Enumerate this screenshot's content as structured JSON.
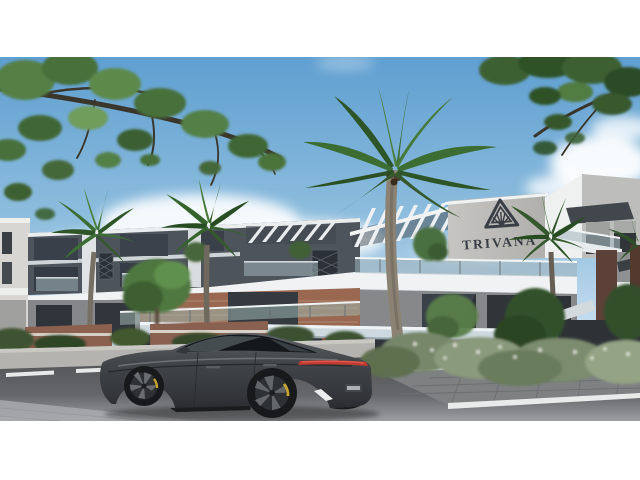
{
  "branding": {
    "name": "TRIVANA",
    "logo_icon": "nested-triangle-pyramid"
  },
  "scene": {
    "type": "architectural exterior rendering, letterboxed 16:9 image on white",
    "setting": "Modern two-storey residential complex with TRIVANA sign, palm trees, overhanging branches, shrubs, street with lane markings and a dark grey fastback sports sedan",
    "sign_text": "TRIVANA"
  },
  "colors": {
    "letterbox": "#ffffff",
    "sky_top": "#5f9fd1",
    "sky_horizon": "#d6e6f0",
    "cloud": "#ffffff",
    "building_dark": "#4d545c",
    "building_white": "#eef1f2",
    "sign_wall": "#bcbbb8",
    "sign_text": "#383d44",
    "brick_accent": "#9a6850",
    "maroon_end_wall": "#5d4138",
    "awning_band": "#cdd9df",
    "dark_awning": "#42474d",
    "glass": "#2f343a",
    "foliage_dark": "#2e5527",
    "foliage_mid": "#3c6e33",
    "foliage_light": "#5f8c4c",
    "palm_trunk": "#8b8274",
    "road": "#58595a",
    "pavement": "#9a9b9d",
    "far_wall": "#b4b3af",
    "lane_marking": "#e9ebea",
    "car_body": "#3d4145",
    "car_glass": "#15181b",
    "car_taillight": "#c23b30",
    "brake_caliper": "#c7a42e"
  }
}
